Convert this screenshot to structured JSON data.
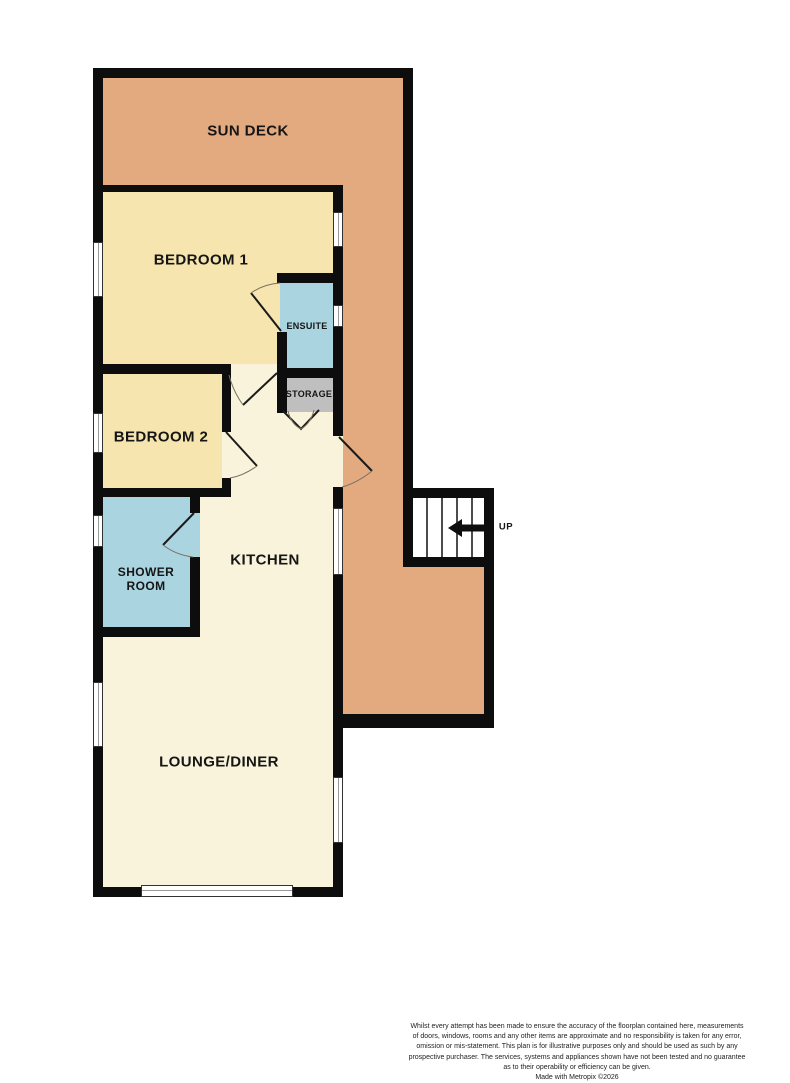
{
  "plan": {
    "rooms": [
      {
        "id": "sun-deck",
        "label": "SUN DECK"
      },
      {
        "id": "bedroom-1",
        "label": "BEDROOM 1"
      },
      {
        "id": "ensuite",
        "label": "ENSUITE"
      },
      {
        "id": "storage",
        "label": "STORAGE"
      },
      {
        "id": "bedroom-2",
        "label": "BEDROOM 2"
      },
      {
        "id": "kitchen",
        "label": "KITCHEN"
      },
      {
        "id": "shower-room",
        "label": "SHOWER\nROOM"
      },
      {
        "id": "lounge-diner",
        "label": "LOUNGE/DINER"
      }
    ],
    "stairs": {
      "direction_label": "UP"
    }
  },
  "footer": {
    "disclaimer_lines": [
      "Whilst every attempt has been made to ensure the accuracy of the floorplan contained here, measurements",
      "of doors, windows, rooms and any other items are approximate and no responsibility is taken for any error,",
      "omission or mis-statement. This plan is for illustrative purposes only and should be used as such by any",
      "prospective purchaser. The services, systems and appliances shown have not been tested and no guarantee",
      "as to their operability or efficiency can be given."
    ],
    "credit": "Made with Metropix ©2026"
  },
  "colors": {
    "wall": "#0d0d0d",
    "sun_deck_fill": "#e3aa80",
    "bedroom_fill": "#f6e5ae",
    "living_fill": "#f8f3da",
    "bathroom_fill": "#aad4e0",
    "storage_fill": "#bfbfbf",
    "window_fill": "#ffffff",
    "window_frame": "#333333",
    "door_line": "#1a1a1a",
    "swing_arc": "#7a7060",
    "label_text": "#151515",
    "disclaimer_text": "#222222"
  }
}
